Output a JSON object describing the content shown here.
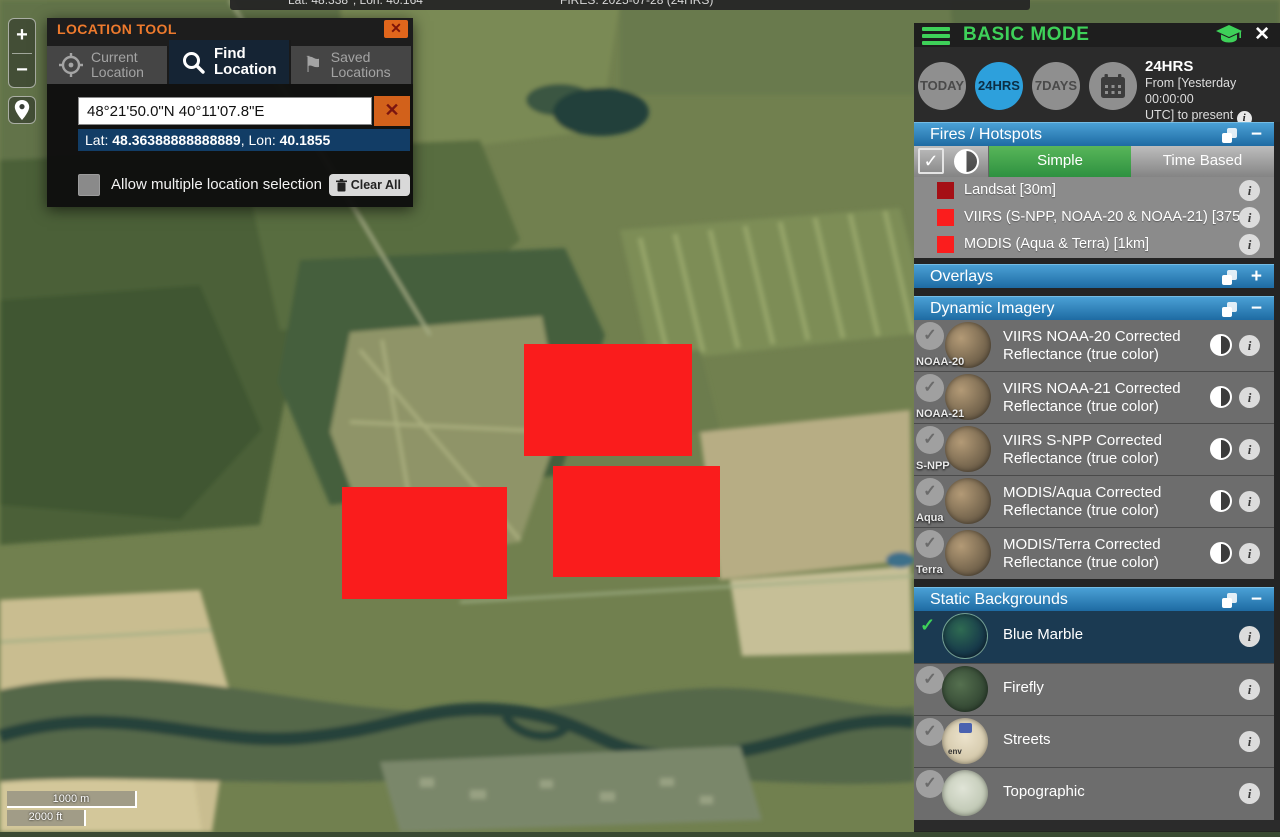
{
  "top_bar": {
    "coords": "Lat: 48.338°, Lon: 40.164°",
    "fires": "FIRES: 2025-07-28 (24HRS)"
  },
  "map_controls": {
    "zoom_in": "+",
    "zoom_out": "−",
    "scale_metric": "1000 m",
    "scale_imperial": "2000 ft"
  },
  "icons": {
    "check": "✓",
    "info": "i",
    "plus": "+",
    "minus": "−",
    "close": "✕",
    "flag": "⚑"
  },
  "location_tool": {
    "title": "LOCATION TOOL",
    "tabs": [
      {
        "line1": "Current",
        "line2": "Location"
      },
      {
        "line1": "Find",
        "line2": "Location"
      },
      {
        "line1": "Saved",
        "line2": "Locations"
      }
    ],
    "search_value": "48°21'50.0\"N 40°11'07.8\"E",
    "lat_label": "Lat: ",
    "lat_value": "48.36388888888889",
    "sep": ", ",
    "lon_label": "Lon: ",
    "lon_value": "40.1855",
    "checkbox_label": "Allow multiple location selection",
    "clear_all_label": "Clear All"
  },
  "panel": {
    "title": "BASIC MODE",
    "time": {
      "buttons": [
        "TODAY",
        "24HRS",
        "7DAYS"
      ],
      "active": "24HRS",
      "summary_title": "24HRS",
      "summary_line1": "From [Yesterday 00:00:00",
      "summary_line2": "UTC] to present "
    },
    "fires_section": {
      "title": "Fires / Hotspots",
      "toggle_simple": "Simple",
      "toggle_time_based": "Time Based",
      "legend": [
        {
          "label": "Landsat [30m]",
          "color": "#a50f15"
        },
        {
          "label": "VIIRS (S-NPP, NOAA-20 & NOAA-21) [375m]",
          "color": "#fb1d1d"
        },
        {
          "label": "MODIS (Aqua & Terra) [1km]",
          "color": "#fb1d1d"
        }
      ]
    },
    "overlays_section": {
      "title": "Overlays"
    },
    "dynamic_section": {
      "title": "Dynamic Imagery",
      "items": [
        {
          "badge": "NOAA-20",
          "line1": "VIIRS NOAA-20 Corrected",
          "line2": "Reflectance (true color)"
        },
        {
          "badge": "NOAA-21",
          "line1": "VIIRS NOAA-21 Corrected",
          "line2": "Reflectance (true color)"
        },
        {
          "badge": "S-NPP",
          "line1": "VIIRS S-NPP Corrected",
          "line2": "Reflectance (true color)"
        },
        {
          "badge": "Aqua",
          "line1": "MODIS/Aqua Corrected",
          "line2": "Reflectance (true color)"
        },
        {
          "badge": "Terra",
          "line1": "MODIS/Terra Corrected",
          "line2": "Reflectance (true color)"
        }
      ]
    },
    "static_section": {
      "title": "Static Backgrounds",
      "items": [
        {
          "label": "Blue Marble"
        },
        {
          "label": "Firefly"
        },
        {
          "label": "Streets",
          "thumb_text": "env"
        },
        {
          "label": "Topographic"
        }
      ]
    }
  },
  "fires_on_map": [
    {
      "x": 524,
      "y": 344,
      "w": 168,
      "h": 112
    },
    {
      "x": 553,
      "y": 466,
      "w": 167,
      "h": 111
    },
    {
      "x": 342,
      "y": 487,
      "w": 165,
      "h": 112
    }
  ],
  "colors": {
    "accent_green": "#3ed159",
    "accent_blue": "#2da0dc",
    "fire_red": "#fa1c1c",
    "orange": "#e0661c"
  }
}
